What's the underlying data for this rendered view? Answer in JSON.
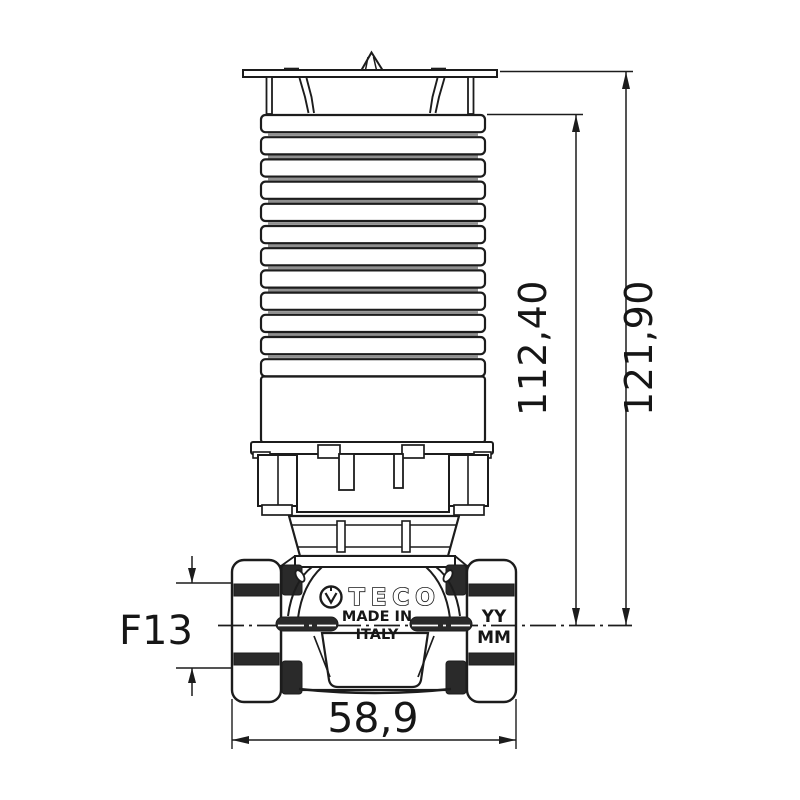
{
  "drawing": {
    "colors": {
      "line": "#1c1c1c",
      "dark_fill": "#2a2a2a",
      "fin_shade": "#8f8f8f",
      "background": "#ffffff"
    },
    "fins": {
      "count": 12
    },
    "branding": {
      "logo": "TECO",
      "made_in_top": "MADE IN",
      "made_in_bottom": "ITALY",
      "date_code_top": "YY",
      "date_code_bottom": "MM"
    },
    "dimensions": {
      "overall_height": "121,90",
      "actuator_height": "112,40",
      "port_size": "F13",
      "body_width": "58,9"
    }
  }
}
